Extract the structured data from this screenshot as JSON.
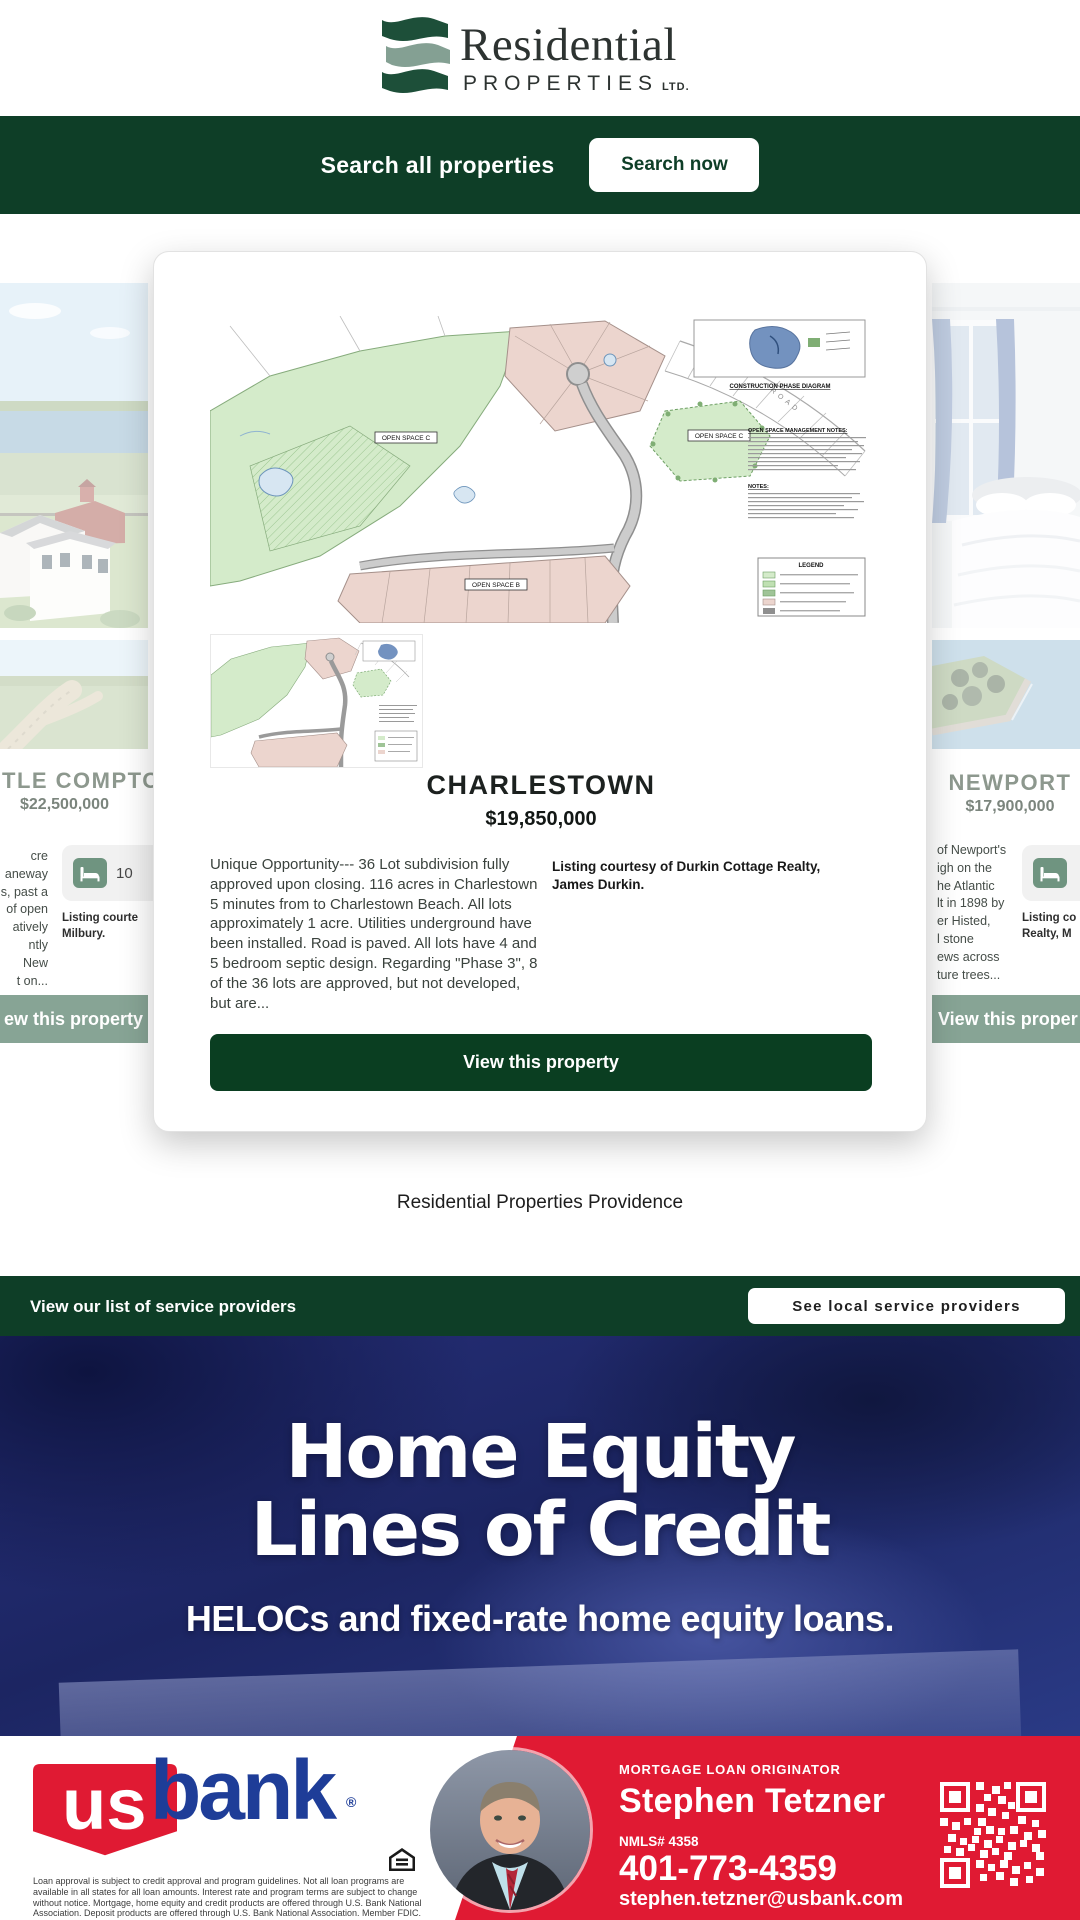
{
  "colors": {
    "brand_green": "#0e3e27",
    "sage": "#87a495",
    "bank_red": "#e01a33",
    "bank_blue": "#1e3d98",
    "banner_navy": "#1c2562"
  },
  "header": {
    "logo_line1": "Residential",
    "logo_line2": "PROPERTIES",
    "logo_suffix": "LTD."
  },
  "search_bar": {
    "label": "Search all properties",
    "button": "Search now"
  },
  "modal": {
    "title": "CHARLESTOWN",
    "price": "$19,850,000",
    "description": "Unique Opportunity--- 36 Lot subdivision fully approved upon closing. 116 acres in Charlestown 5 minutes from to Charlestown Beach. All lots approximately 1 acre. Utilities underground have been installed. Road is paved. All lots have 4 and 5 bedroom septic design. Regarding \"Phase 3\", 8 of the 36 lots are approved, but not developed, but are...",
    "listing_courtesy": "Listing courtesy of Durkin Cottage Realty, James Durkin.",
    "button": "View this property",
    "site_plan": {
      "open_space_c": "OPEN SPACE C",
      "open_space_c2": "OPEN SPACE C",
      "open_space_b": "OPEN SPACE B",
      "inset_caption": "CONSTRUCTION PHASE DIAGRAM",
      "legend_title": "LEGEND",
      "notes_heading": "OPEN SPACE MANAGEMENT NOTES:",
      "notes2_heading": "NOTES:"
    }
  },
  "left_card": {
    "title": "TLE COMPTON",
    "price": "$22,500,000",
    "desc_fragments": [
      "cre",
      "aneway",
      "s, past a",
      "of open",
      "atively",
      "ntly",
      "New",
      "t on..."
    ],
    "bed_count": "10",
    "listing_fragments": [
      "Listing courte",
      "Milbury."
    ],
    "button_fragment": "ew this property"
  },
  "right_card": {
    "title": "NEWPORT",
    "price": "$17,900,000",
    "desc_fragments": [
      "of Newport's",
      "igh on the",
      "he Atlantic",
      "lt in 1898 by",
      "er Histed,",
      "l stone",
      "ews across",
      "ture trees..."
    ],
    "listing_fragments": [
      "Listing co",
      "Realty, M"
    ],
    "button_fragment": "View this proper"
  },
  "mid_caption": "Residential Properties Providence",
  "service_bar": {
    "label": "View our list of service providers",
    "button": "See local service providers"
  },
  "banner": {
    "line1": "Home Equity",
    "line2": "Lines of Credit",
    "subtitle": "HELOCs and fixed-rate home equity loans."
  },
  "footer": {
    "bank_us": "us",
    "bank_word": "bank",
    "reg": "®",
    "disclaimer": "Loan approval is subject to credit approval and program guidelines. Not all loan programs are available in all states for all loan amounts. Interest rate and program terms are subject to change without notice. Mortgage, home equity and credit products are offered through U.S. Bank National Association. Deposit products are offered through U.S. Bank National Association. Member FDIC.",
    "role": "MORTGAGE LOAN ORIGINATOR",
    "name": "Stephen Tetzner",
    "nmls": "NMLS# 4358",
    "phone": "401-773-4359",
    "email": "stephen.tetzner@usbank.com"
  }
}
